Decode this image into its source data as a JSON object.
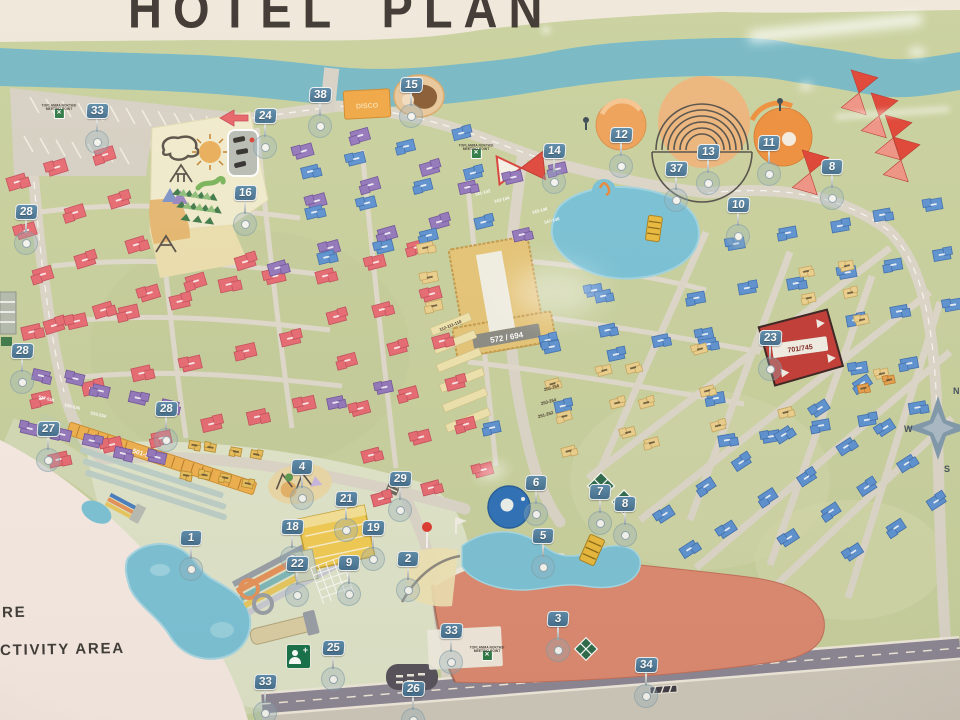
{
  "title": "HOTEL PLAN",
  "legend": {
    "line1": "RE",
    "line2": "CTIVITY AREA"
  },
  "meeting_point": {
    "line1": "TOPLANMA NOKTASI",
    "line2": "MEETING POINT"
  },
  "named_buildings": {
    "central_block": "572 / 694",
    "club_building": "701/745",
    "lodge_strip": "501-578",
    "disco": "DISCO"
  },
  "compass": {
    "n": "N",
    "w": "W",
    "s": "S"
  },
  "colors": {
    "ground": "#c9d19e",
    "river": "#76b9c6",
    "road": "#dcd6c9",
    "main_road": "#8d8795",
    "pink_building": "#e76b72",
    "purple_building": "#9478bc",
    "blue_building": "#5d92d1",
    "yellow_building": "#ecd08d",
    "orange_strip": "#f0b14e",
    "red_club": "#c33b36",
    "marker_flag": "#4d7ea1",
    "pool": "#7cc3d7",
    "deep_pool": "#2e72b8",
    "salmon_building": "#dd8a70",
    "paper": "#f7ebe4",
    "title_ink": "#3b3430"
  },
  "markers": [
    {
      "n": "33",
      "x": 97,
      "y": 112
    },
    {
      "n": "24",
      "x": 265,
      "y": 117
    },
    {
      "n": "38",
      "x": 320,
      "y": 96
    },
    {
      "n": "15",
      "x": 411,
      "y": 86
    },
    {
      "n": "14",
      "x": 554,
      "y": 152
    },
    {
      "n": "12",
      "x": 621,
      "y": 136
    },
    {
      "n": "37",
      "x": 676,
      "y": 170
    },
    {
      "n": "13",
      "x": 708,
      "y": 153
    },
    {
      "n": "11",
      "x": 769,
      "y": 144
    },
    {
      "n": "8",
      "x": 832,
      "y": 168
    },
    {
      "n": "10",
      "x": 738,
      "y": 206
    },
    {
      "n": "28",
      "x": 26,
      "y": 213
    },
    {
      "n": "16",
      "x": 245,
      "y": 194
    },
    {
      "n": "28",
      "x": 22,
      "y": 352
    },
    {
      "n": "28",
      "x": 166,
      "y": 410
    },
    {
      "n": "27",
      "x": 48,
      "y": 430
    },
    {
      "n": "4",
      "x": 302,
      "y": 468
    },
    {
      "n": "29",
      "x": 400,
      "y": 480
    },
    {
      "n": "21",
      "x": 346,
      "y": 500
    },
    {
      "n": "18",
      "x": 292,
      "y": 528
    },
    {
      "n": "19",
      "x": 373,
      "y": 529
    },
    {
      "n": "9",
      "x": 349,
      "y": 564
    },
    {
      "n": "22",
      "x": 297,
      "y": 565
    },
    {
      "n": "2",
      "x": 408,
      "y": 560
    },
    {
      "n": "1",
      "x": 191,
      "y": 539
    },
    {
      "n": "6",
      "x": 536,
      "y": 484
    },
    {
      "n": "7",
      "x": 600,
      "y": 493
    },
    {
      "n": "8",
      "x": 625,
      "y": 505
    },
    {
      "n": "5",
      "x": 543,
      "y": 537
    },
    {
      "n": "3",
      "x": 558,
      "y": 620
    },
    {
      "n": "23",
      "x": 770,
      "y": 339
    },
    {
      "n": "25",
      "x": 333,
      "y": 649
    },
    {
      "n": "33",
      "x": 265,
      "y": 683
    },
    {
      "n": "33",
      "x": 451,
      "y": 632
    },
    {
      "n": "26",
      "x": 413,
      "y": 690
    },
    {
      "n": "34",
      "x": 646,
      "y": 666
    }
  ],
  "meeting_points": [
    {
      "x": 59,
      "y": 104
    },
    {
      "x": 476,
      "y": 144
    },
    {
      "x": 487,
      "y": 646
    }
  ],
  "building_labels": [
    {
      "text": "537-538",
      "x": 46,
      "y": 400,
      "r": 13,
      "c": "#ffffff"
    },
    {
      "text": "535-536",
      "x": 72,
      "y": 408,
      "r": 13,
      "c": "#ffffff"
    },
    {
      "text": "533-534",
      "x": 98,
      "y": 416,
      "r": 13,
      "c": "#ffffff"
    },
    {
      "text": "141-142",
      "x": 483,
      "y": 194,
      "r": -14,
      "c": "#ffffff"
    },
    {
      "text": "143-144",
      "x": 502,
      "y": 201,
      "r": -14,
      "c": "#ffffff"
    },
    {
      "text": "145-146",
      "x": 540,
      "y": 212,
      "r": -14,
      "c": "#ffffff"
    },
    {
      "text": "147-148",
      "x": 552,
      "y": 222,
      "r": -14,
      "c": "#ffffff"
    },
    {
      "text": "112-111-110",
      "x": 451,
      "y": 327,
      "r": -22,
      "c": "#453a2c"
    },
    {
      "text": "255-256",
      "x": 552,
      "y": 389,
      "r": -16,
      "c": "#453a2c"
    },
    {
      "text": "253-254",
      "x": 549,
      "y": 403,
      "r": -16,
      "c": "#453a2c"
    },
    {
      "text": "251-252",
      "x": 546,
      "y": 416,
      "r": -16,
      "c": "#453a2c"
    }
  ],
  "clusters": [
    {
      "name": "pink-nw",
      "color": "#e76b72",
      "stroke": "#c44f5c",
      "x": 30,
      "y": 148,
      "w": 198,
      "h": 148,
      "cols": 5,
      "rows": 4,
      "angle": -17,
      "bw": 19,
      "bh": 13,
      "t": "l"
    },
    {
      "name": "pink-w",
      "color": "#e76b72",
      "stroke": "#c44f5c",
      "x": 42,
      "y": 302,
      "w": 255,
      "h": 130,
      "cols": 6,
      "rows": 3,
      "angle": -13,
      "bw": 19,
      "bh": 13,
      "t": "l"
    },
    {
      "name": "pink-central",
      "color": "#e76b72",
      "stroke": "#c44f5c",
      "x": 352,
      "y": 258,
      "w": 100,
      "h": 230,
      "cols": 3,
      "rows": 6,
      "angle": -15,
      "bw": 18,
      "bh": 12,
      "t": "l"
    },
    {
      "name": "purple-n",
      "color": "#9478bc",
      "stroke": "#6f539b",
      "x": 262,
      "y": 142,
      "w": 168,
      "h": 102,
      "cols": 4,
      "rows": 3,
      "angle": -16,
      "bw": 18,
      "bh": 12,
      "t": "l"
    },
    {
      "name": "purple-ne",
      "color": "#9478bc",
      "stroke": "#6f539b",
      "x": 470,
      "y": 178,
      "w": 96,
      "h": 54,
      "cols": 3,
      "rows": 2,
      "angle": -13,
      "bw": 17,
      "bh": 11,
      "t": "l"
    },
    {
      "name": "purple-row-sw",
      "color": "#9478bc",
      "stroke": "#6f539b",
      "x": 34,
      "y": 388,
      "w": 128,
      "h": 56,
      "cols": 5,
      "rows": 2,
      "angle": 13,
      "bw": 17,
      "bh": 11,
      "t": "l"
    },
    {
      "name": "purple-mid",
      "color": "#9478bc",
      "stroke": "#6f539b",
      "x": 338,
      "y": 395,
      "w": 54,
      "h": 36,
      "cols": 2,
      "rows": 1,
      "angle": -12,
      "bw": 16,
      "bh": 11,
      "t": "l"
    },
    {
      "name": "blue-n",
      "color": "#5d92d1",
      "stroke": "#3f6fae",
      "x": 316,
      "y": 150,
      "w": 158,
      "h": 90,
      "cols": 4,
      "rows": 3,
      "angle": -14,
      "bw": 17,
      "bh": 11,
      "t": "l"
    },
    {
      "name": "blue-c1",
      "color": "#5d92d1",
      "stroke": "#3f6fae",
      "x": 484,
      "y": 258,
      "w": 112,
      "h": 84,
      "cols": 3,
      "rows": 3,
      "angle": -12,
      "bw": 16,
      "bh": 11,
      "t": "l"
    },
    {
      "name": "blue-c2",
      "color": "#5d92d1",
      "stroke": "#3f6fae",
      "x": 612,
      "y": 284,
      "w": 86,
      "h": 60,
      "cols": 3,
      "rows": 2,
      "angle": -12,
      "bw": 16,
      "bh": 11,
      "t": "l"
    },
    {
      "name": "blue-e",
      "color": "#5d92d1",
      "stroke": "#3f6fae",
      "x": 706,
      "y": 228,
      "w": 246,
      "h": 196,
      "cols": 6,
      "rows": 5,
      "angle": -10,
      "bw": 17,
      "bh": 11,
      "t": "l"
    },
    {
      "name": "blue-se",
      "color": "#5d92d1",
      "stroke": "#3f6fae",
      "x": 640,
      "y": 450,
      "w": 280,
      "h": 140,
      "cols": 7,
      "rows": 4,
      "angle": -33,
      "bw": 17,
      "bh": 11,
      "t": "l"
    },
    {
      "name": "blue-s-pocket",
      "color": "#5d92d1",
      "stroke": "#3f6fae",
      "x": 482,
      "y": 352,
      "w": 76,
      "h": 66,
      "cols": 2,
      "rows": 2,
      "angle": -12,
      "bw": 16,
      "bh": 11,
      "t": "l"
    },
    {
      "name": "yellow-w",
      "color": "#ecd08d",
      "stroke": "#c8a75f",
      "x": 430,
      "y": 246,
      "w": 34,
      "h": 56,
      "cols": 1,
      "rows": 3,
      "angle": -12,
      "bw": 16,
      "bh": 10,
      "t": "d"
    },
    {
      "name": "yellow-e",
      "color": "#ecd08d",
      "stroke": "#c8a75f",
      "x": 526,
      "y": 268,
      "w": 30,
      "h": 40,
      "cols": 1,
      "rows": 2,
      "angle": -12,
      "bw": 15,
      "bh": 10,
      "t": "d"
    },
    {
      "name": "yellow-s",
      "color": "#e9bf5c",
      "stroke": "#b98c2e",
      "x": 188,
      "y": 448,
      "w": 64,
      "h": 30,
      "cols": 4,
      "rows": 2,
      "angle": 10,
      "bw": 11,
      "bh": 8,
      "t": "d"
    },
    {
      "name": "yellow-se-a",
      "color": "#ecd08d",
      "stroke": "#c8a75f",
      "x": 560,
      "y": 378,
      "w": 58,
      "h": 64,
      "cols": 2,
      "rows": 3,
      "angle": -15,
      "bw": 14,
      "bh": 9,
      "t": "d"
    },
    {
      "name": "yellow-se-b",
      "color": "#ecd08d",
      "stroke": "#c8a75f",
      "x": 642,
      "y": 346,
      "w": 136,
      "h": 82,
      "cols": 3,
      "rows": 3,
      "angle": -15,
      "bw": 14,
      "bh": 9,
      "t": "d"
    },
    {
      "name": "yellow-e2",
      "color": "#ecd08d",
      "stroke": "#c8a75f",
      "x": 812,
      "y": 266,
      "w": 42,
      "h": 56,
      "cols": 2,
      "rows": 3,
      "angle": -12,
      "bw": 13,
      "bh": 9,
      "t": "d"
    },
    {
      "name": "yellow-e3",
      "color": "#ecd08d",
      "stroke": "#c8a75f",
      "x": 828,
      "y": 378,
      "w": 54,
      "h": 24,
      "cols": 2,
      "rows": 1,
      "angle": -12,
      "bw": 13,
      "bh": 9,
      "t": "d"
    },
    {
      "name": "orange-e",
      "color": "#e8a04c",
      "stroke": "#bd7c2e",
      "x": 862,
      "y": 384,
      "w": 28,
      "h": 20,
      "cols": 2,
      "rows": 1,
      "angle": -12,
      "bw": 11,
      "bh": 8,
      "t": "d"
    }
  ]
}
